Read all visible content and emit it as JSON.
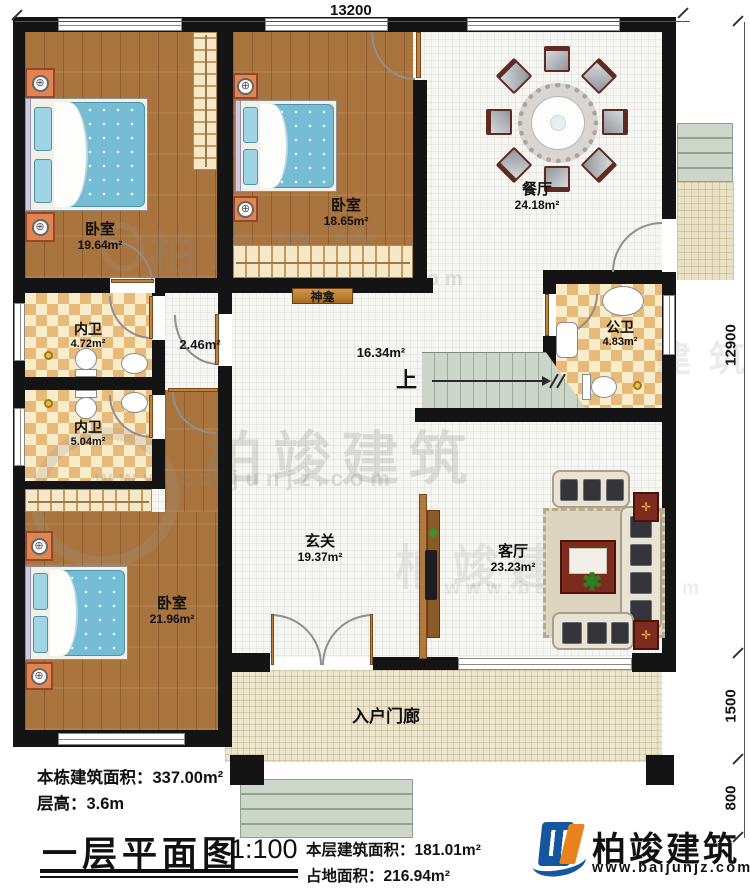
{
  "dimensions": {
    "top": "13200",
    "right_main": "12900",
    "right_porch": "1500",
    "right_steps": "800"
  },
  "rooms": {
    "bedroom1": {
      "name": "卧室",
      "area": "19.64m²"
    },
    "bedroom2": {
      "name": "卧室",
      "area": "18.65m²"
    },
    "bedroom3": {
      "name": "卧室",
      "area": "21.96m²"
    },
    "dining": {
      "name": "餐厅",
      "area": "24.18m²"
    },
    "bath1": {
      "name": "内卫",
      "area": "4.72m²"
    },
    "bath2": {
      "name": "内卫",
      "area": "5.04m²"
    },
    "public_bath": {
      "name": "公卫",
      "area": "4.83m²"
    },
    "hall": {
      "area": "16.34m²"
    },
    "corridor": {
      "area": "2.46m²"
    },
    "foyer": {
      "name": "玄关",
      "area": "19.37m²"
    },
    "living": {
      "name": "客厅",
      "area": "23.23m²"
    },
    "porch": {
      "name": "入户门廊"
    },
    "shrine": {
      "name": "神龛"
    },
    "stairs": {
      "up_label": "上"
    }
  },
  "title_block": {
    "building_area": "本栋建筑面积：337.00m²",
    "floor_height": "层高：3.6m",
    "title": "一层平面图",
    "scale": "1:100",
    "floor_area": "本层建筑面积：181.01m²",
    "footprint_area": "占地面积：216.94m²"
  },
  "logo": {
    "name": "柏竣建筑",
    "url": "www.baijunjz.com"
  },
  "watermark": {
    "name": "柏竣建筑",
    "url": "www.baijunjz.com",
    "fragment": "建 筑"
  },
  "colors": {
    "wall": "#141414",
    "wood": "#a9743d",
    "checker_tan": "#e7ba79",
    "tile": "#f5f5f2",
    "porch": "#ece6cf",
    "mattress": "#74bdd4",
    "logo_blue": "#1456a0",
    "logo_orange": "#e9821e"
  }
}
